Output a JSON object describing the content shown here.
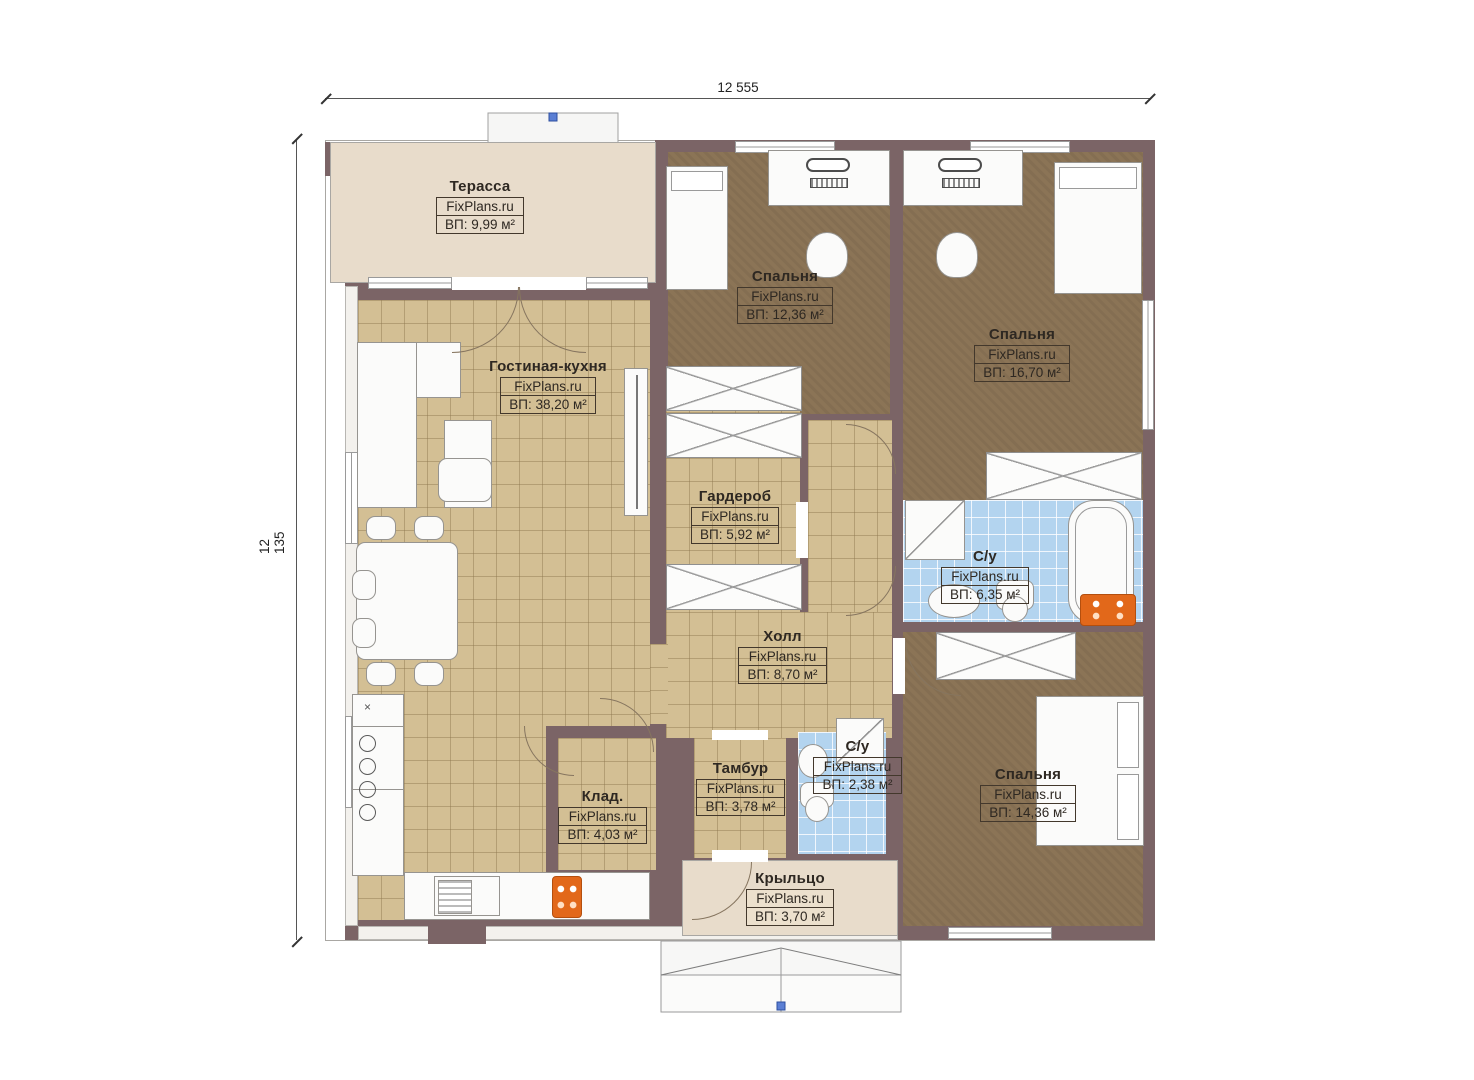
{
  "brand": "FixPlans.ru",
  "dimensions": {
    "width_top": "12 555",
    "height_left": "12 135"
  },
  "rooms": {
    "terrace": {
      "name": "Терасса",
      "area": "ВП: 9,99 м²"
    },
    "living_kitchen": {
      "name": "Гостиная-кухня",
      "area": "ВП: 38,20 м²"
    },
    "bedroom_top": {
      "name": "Спальня",
      "area": "ВП: 12,36 м²"
    },
    "bedroom_right": {
      "name": "Спальня",
      "area": "ВП: 16,70 м²"
    },
    "wardrobe": {
      "name": "Гардероб",
      "area": "ВП: 5,92 м²"
    },
    "bathroom_main": {
      "name": "С/у",
      "area": "ВП: 6,35 м²"
    },
    "hall": {
      "name": "Холл",
      "area": "ВП: 8,70 м²"
    },
    "pantry": {
      "name": "Клад.",
      "area": "ВП: 4,03 м²"
    },
    "vestibule": {
      "name": "Тамбур",
      "area": "ВП: 3,78 м²"
    },
    "bathroom_small": {
      "name": "С/у",
      "area": "ВП: 2,38 м²"
    },
    "bedroom_bottom": {
      "name": "Спальня",
      "area": "ВП: 14,36 м²"
    },
    "porch": {
      "name": "Крыльцо",
      "area": "ВП: 3,70 м²"
    }
  },
  "misc": {
    "kitchen_x_mark": "×"
  },
  "colors": {
    "wall": "#7b6466",
    "tile_floor": "#d3bf94",
    "carpet_floor": "#8b7456",
    "bath_tile": "#b3d4ef",
    "terrace_floor": "#e8dccb",
    "radiator": "#e2681a"
  }
}
